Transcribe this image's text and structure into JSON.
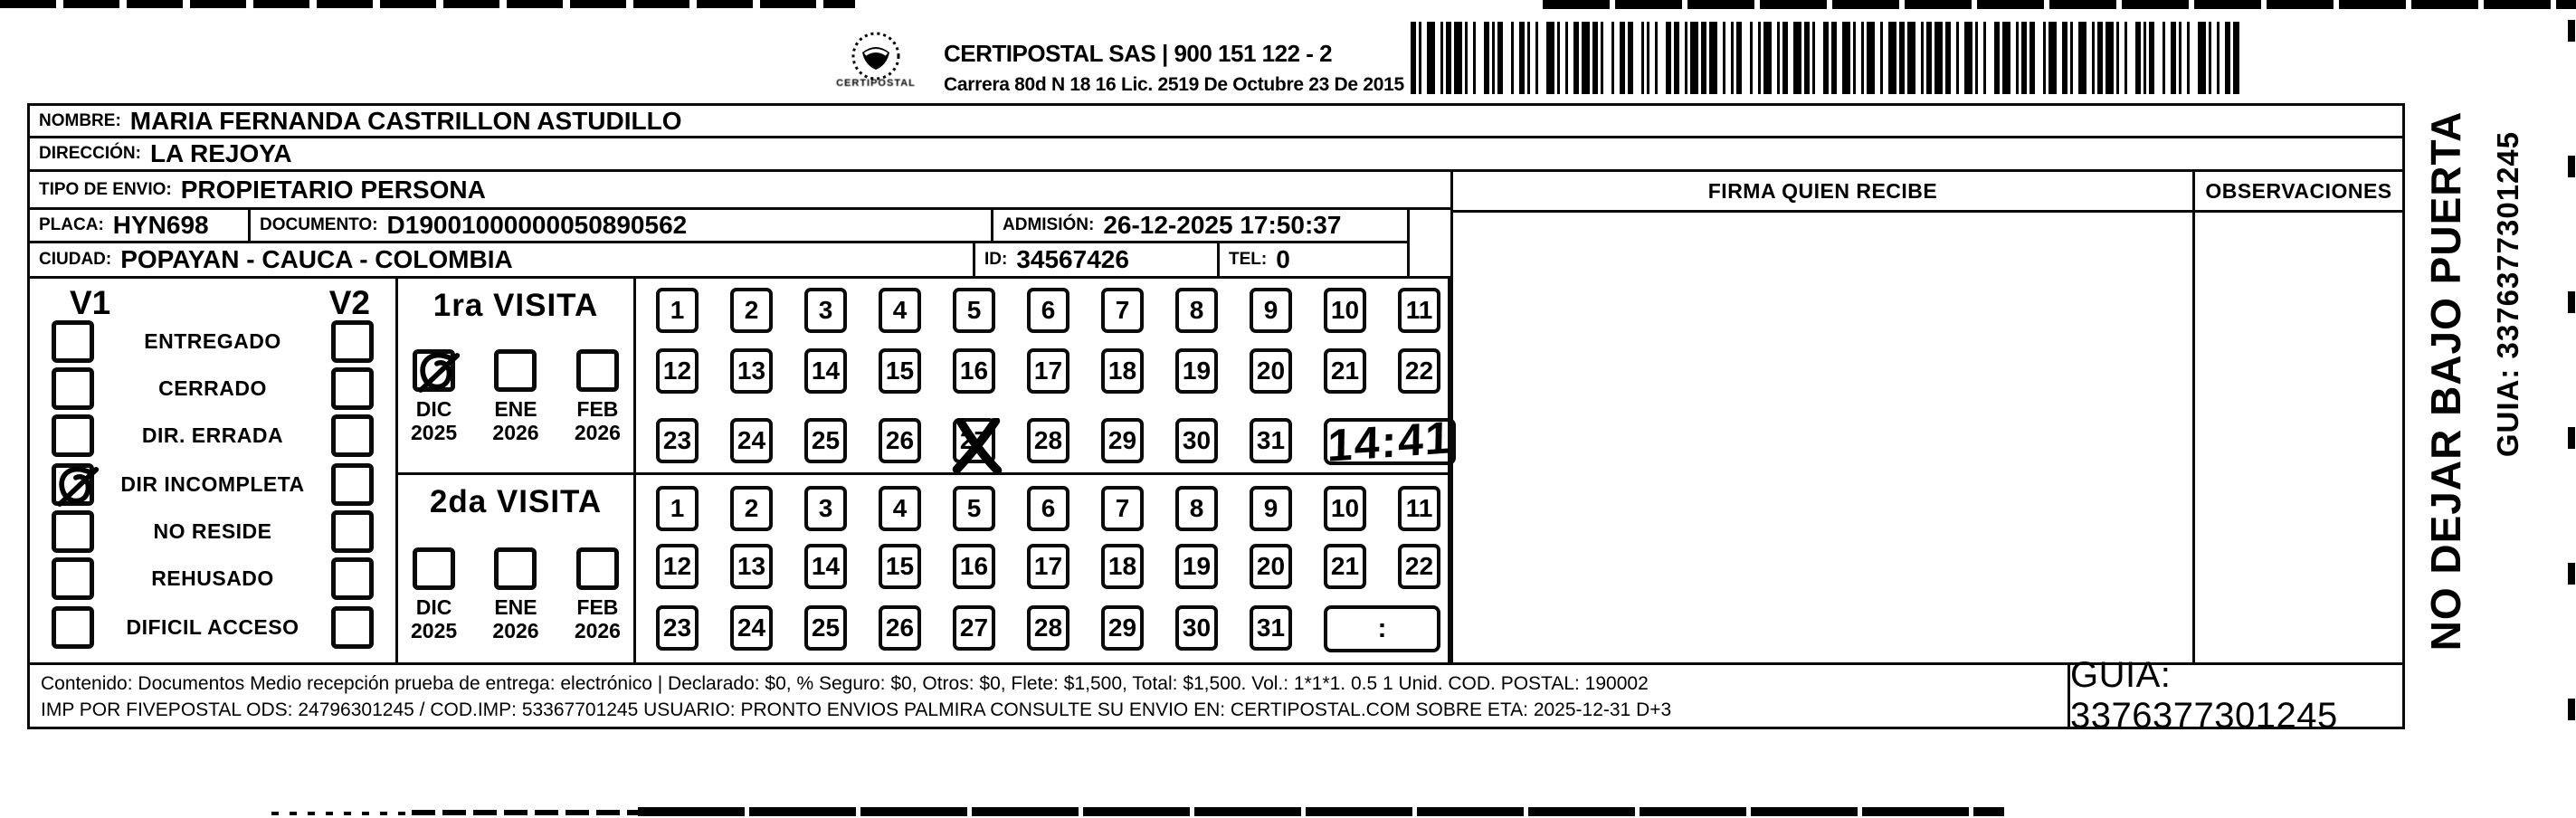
{
  "header": {
    "sender_line1": "SEC. TRANSITO Y TRA",
    "sender_line2": "NSPORTE DE POPAYAN",
    "nit": "NIT 891 580 006 - TEL 602 8200810",
    "sender_address": "CARRERA 2 CALLE 25 N POMONA VIA AL HUILA",
    "brand": "CERTIPOSTAL SAS | 900 151 122 - 2",
    "brand_address": "Carrera 80d N 18 16  Lic. 2519 De Octubre 23 De 2015",
    "logo_caption": "CERTIPOSTAL"
  },
  "recipient": {
    "nombre_label": "NOMBRE:",
    "nombre": "MARIA FERNANDA CASTRILLON ASTUDILLO",
    "direccion_label": "DIRECCIÓN:",
    "direccion": "LA REJOYA",
    "tipo_label": "TIPO DE ENVIO:",
    "tipo": "PROPIETARIO PERSONA",
    "placa_label": "PLACA:",
    "placa": "HYN698",
    "documento_label": "DOCUMENTO:",
    "documento": "D19001000000050890562",
    "admision_label": "ADMISIÓN:",
    "admision": "26-12-2025 17:50:37",
    "ciudad_label": "CIUDAD:",
    "ciudad": "POPAYAN - CAUCA - COLOMBIA",
    "id_label": "ID:",
    "id": "34567426",
    "tel_label": "TEL:",
    "tel": "0"
  },
  "signature": {
    "firma_header": "FIRMA QUIEN RECIBE",
    "observaciones_header": "OBSERVACIONES"
  },
  "status": {
    "v1": "V1",
    "v2": "V2",
    "options": [
      {
        "label": "ENTREGADO",
        "v1_checked": false,
        "v2_checked": false
      },
      {
        "label": "CERRADO",
        "v1_checked": false,
        "v2_checked": false
      },
      {
        "label": "DIR. ERRADA",
        "v1_checked": false,
        "v2_checked": false
      },
      {
        "label": "DIR INCOMPLETA",
        "v1_checked": true,
        "v2_checked": false
      },
      {
        "label": "NO RESIDE",
        "v1_checked": false,
        "v2_checked": false
      },
      {
        "label": "REHUSADO",
        "v1_checked": false,
        "v2_checked": false
      },
      {
        "label": "DIFICIL ACCESO",
        "v1_checked": false,
        "v2_checked": false
      }
    ]
  },
  "visits": [
    {
      "title": "1ra VISITA",
      "months": [
        {
          "month": "DIC",
          "year": "2025",
          "checked": true
        },
        {
          "month": "ENE",
          "year": "2026",
          "checked": false
        },
        {
          "month": "FEB",
          "year": "2026",
          "checked": false
        }
      ],
      "day_rows": [
        [
          1,
          2,
          3,
          4,
          5,
          6,
          7,
          8,
          9,
          10,
          11
        ],
        [
          12,
          13,
          14,
          15,
          16,
          17,
          18,
          19,
          20,
          21,
          22
        ],
        [
          23,
          24,
          25,
          26,
          27,
          28,
          29,
          30,
          31
        ]
      ],
      "crossed_day": 27,
      "time": "14:41",
      "time_handwritten": true
    },
    {
      "title": "2da VISITA",
      "months": [
        {
          "month": "DIC",
          "year": "2025",
          "checked": false
        },
        {
          "month": "ENE",
          "year": "2026",
          "checked": false
        },
        {
          "month": "FEB",
          "year": "2026",
          "checked": false
        }
      ],
      "day_rows": [
        [
          1,
          2,
          3,
          4,
          5,
          6,
          7,
          8,
          9,
          10,
          11
        ],
        [
          12,
          13,
          14,
          15,
          16,
          17,
          18,
          19,
          20,
          21,
          22
        ],
        [
          23,
          24,
          25,
          26,
          27,
          28,
          29,
          30,
          31
        ]
      ],
      "crossed_day": null,
      "time": ":",
      "time_handwritten": false
    }
  ],
  "footer": {
    "line1": "Contenido: Documentos Medio recepción prueba de entrega: electrónico | Declarado: $0, % Seguro: $0, Otros: $0, Flete: $1,500, Total: $1,500. Vol.: 1*1*1. 0.5  1 Unid. COD. POSTAL: 190002",
    "line2": "IMP POR FIVEPOSTAL ODS: 24796301245 / COD.IMP: 53367701245 USUARIO: PRONTO ENVIOS PALMIRA CONSULTE SU ENVIO EN: CERTIPOSTAL.COM SOBRE ETA: 2025-12-31 D+3",
    "guia": "GUIA: 3376377301245"
  },
  "side_text": {
    "warning": "NO DEJAR BAJO PUERTA",
    "guia": "GUIA: 3376377301245"
  },
  "barcode": {
    "pattern": "2112321121311213211123122112133112122131211312212311121321221131213212112312113211223121132122311211321231213211213122123112132132112123113221123211213112132111231221121331121221312113122123111213212211"
  }
}
